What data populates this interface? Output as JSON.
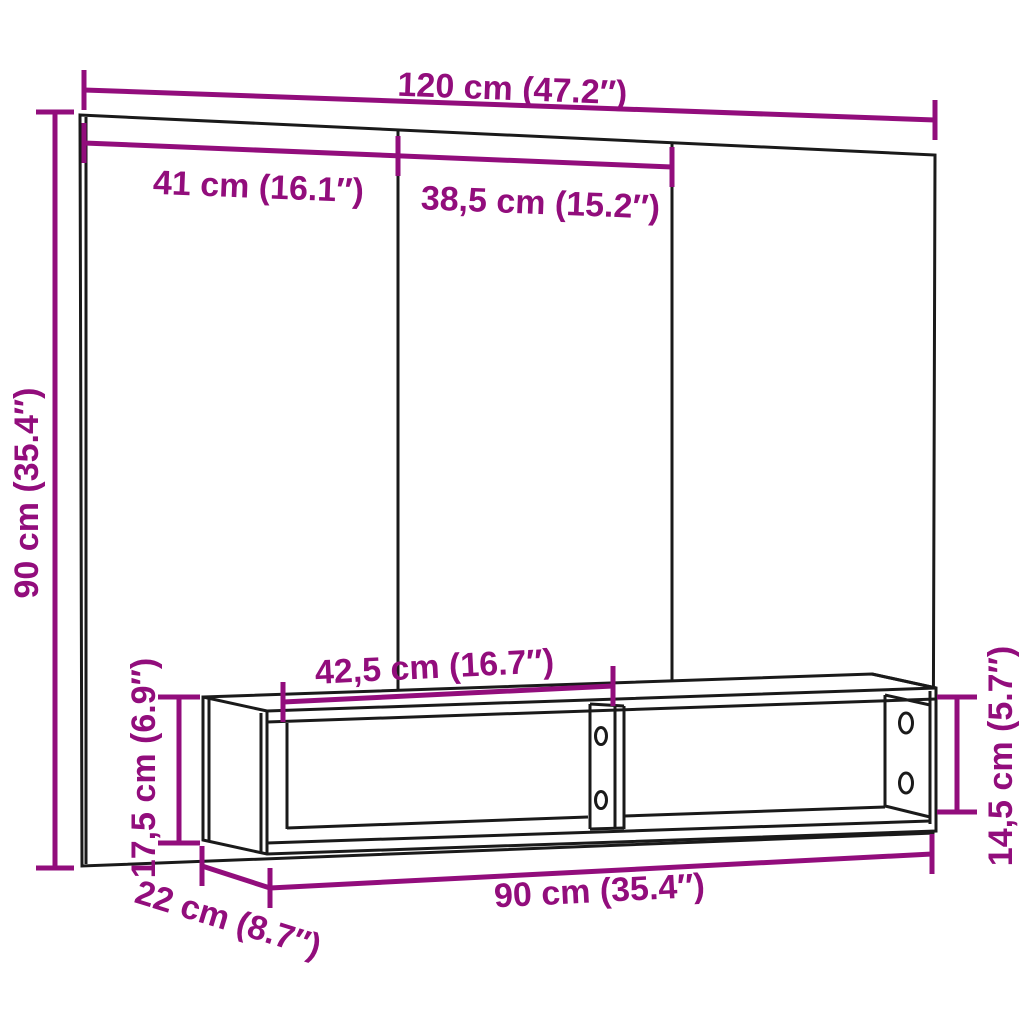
{
  "diagram": {
    "type": "product-dimension-drawing",
    "subject": "wall-mounted TV unit with back panel and open shelf cabinet",
    "colors": {
      "dimension_accent": "#920D7C",
      "line": "#1A1A1A",
      "background": "#FFFFFF"
    },
    "labels": {
      "panel_width": "120 cm (47.2″)",
      "section_left_width": "41 cm (16.1″)",
      "section_middle_width": "38,5 cm (15.2″)",
      "panel_height": "90 cm (35.4″)",
      "compartment_width": "42,5 cm (16.7″)",
      "shelf_height": "17,5 cm (6.9″)",
      "shelf_inner_height": "14,5 cm (5.7″)",
      "shelf_width": "90 cm (35.4″)",
      "shelf_depth": "22 cm (8.7″)"
    },
    "measurements": [
      {
        "part": "back panel width",
        "cm": 120,
        "inches": 47.2
      },
      {
        "part": "back panel left section width",
        "cm": 41,
        "inches": 16.1
      },
      {
        "part": "back panel middle section width",
        "cm": 38.5,
        "inches": 15.2
      },
      {
        "part": "back panel height",
        "cm": 90,
        "inches": 35.4
      },
      {
        "part": "shelf compartment width",
        "cm": 42.5,
        "inches": 16.7
      },
      {
        "part": "shelf outer height",
        "cm": 17.5,
        "inches": 6.9
      },
      {
        "part": "shelf inner height",
        "cm": 14.5,
        "inches": 5.7
      },
      {
        "part": "shelf width",
        "cm": 90,
        "inches": 35.4
      },
      {
        "part": "shelf depth",
        "cm": 22,
        "inches": 8.7
      }
    ]
  }
}
